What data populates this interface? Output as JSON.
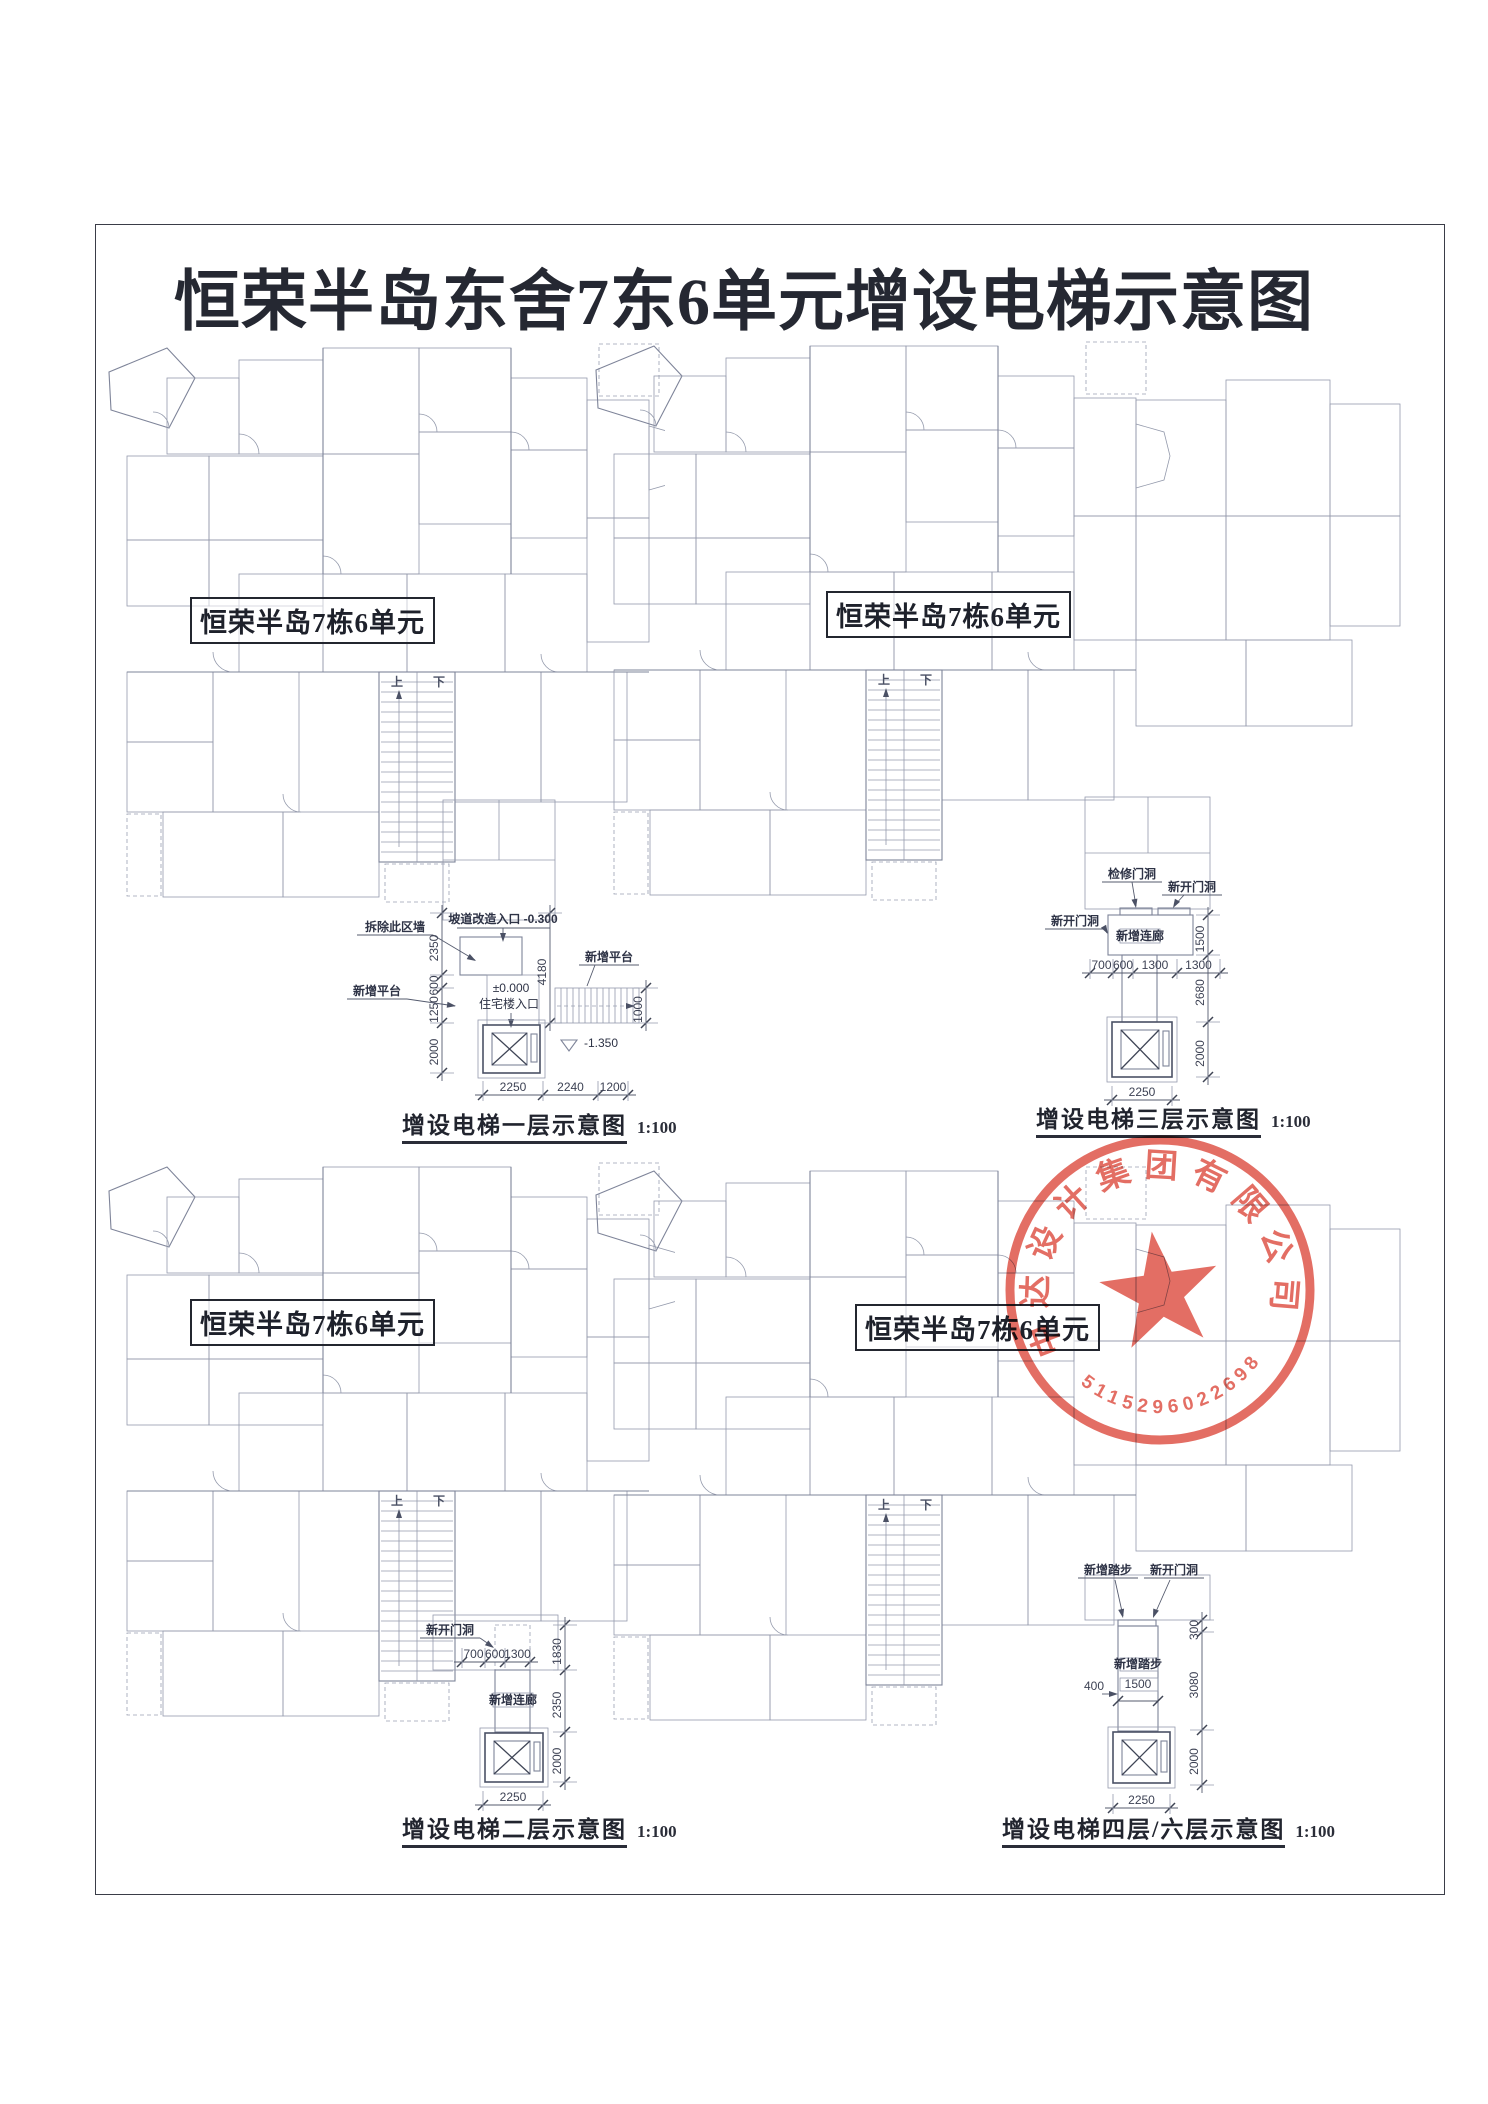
{
  "title": "恒荣半岛东舍7东6单元增设电梯示意图",
  "unit_label": "恒荣半岛7栋6单元",
  "plans": [
    {
      "id": "first-floor",
      "caption": "增设电梯一层示意图",
      "scale": "1:100",
      "dims": {
        "left": [
          "2350",
          "600",
          "1250",
          "2000"
        ],
        "right": [
          "4180"
        ],
        "right2": [
          "1000"
        ],
        "bottom": [
          "2250",
          "2240",
          "1200"
        ]
      },
      "levels": {
        "entry_note": "坡道改造入口 -0.300",
        "zero": "±0.000",
        "entry": "住宅楼入口",
        "pit": "-1.350"
      },
      "leaders": [
        "拆除此区墙",
        "新增平台",
        "新增平台"
      ],
      "stair": {
        "up": "上",
        "down": "下"
      }
    },
    {
      "id": "third-floor",
      "caption": "增设电梯三层示意图",
      "scale": "1:100",
      "dims": {
        "row": [
          "700",
          "600",
          "1300",
          "1300"
        ],
        "right": [
          "1500",
          "2680",
          "2000"
        ],
        "bottom": [
          "2250"
        ]
      },
      "leaders": [
        "检修门洞",
        "新开门洞",
        "新开门洞"
      ],
      "grid_label": "新增连廊",
      "stair": {
        "up": "上",
        "down": "下"
      }
    },
    {
      "id": "second-floor",
      "caption": "增设电梯二层示意图",
      "scale": "1:100",
      "dims": {
        "row": [
          "700",
          "600",
          "1300"
        ],
        "right": [
          "1830",
          "2350",
          "2000"
        ],
        "bottom": [
          "2250"
        ]
      },
      "leaders": [
        "新开门洞"
      ],
      "grid_label": "新增连廊",
      "stair": {
        "up": "上",
        "down": "下"
      }
    },
    {
      "id": "fourth-sixth-floor",
      "caption": "增设电梯四层/六层示意图",
      "scale": "1:100",
      "dims": {
        "left": [
          "400"
        ],
        "inner": [
          "1500"
        ],
        "right": [
          "300",
          "3080",
          "2000"
        ],
        "bottom": [
          "2250"
        ]
      },
      "leaders": [
        "新增踏步",
        "新开门洞"
      ],
      "grid_label": "新增踏步",
      "stair": {
        "up": "上",
        "down": "下"
      }
    }
  ],
  "stamp": {
    "company": "中达设计集团有限公司",
    "number": "5115296022698"
  },
  "colors": {
    "seal": "#e05a4e",
    "line": "#949aac",
    "dark_line": "#4b5165",
    "ink": "#252832"
  }
}
